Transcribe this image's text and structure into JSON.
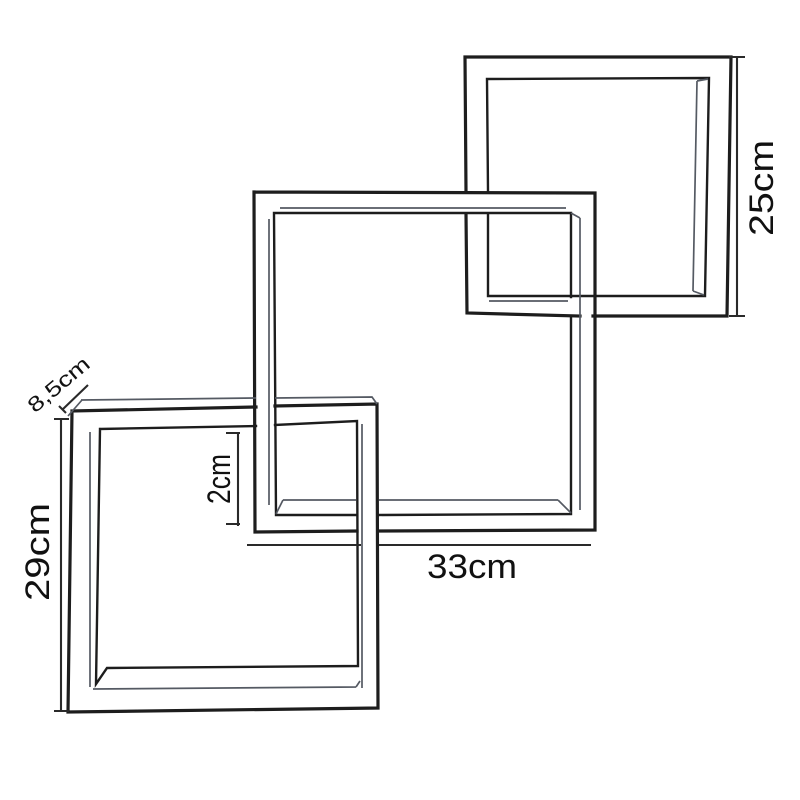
{
  "diagram": {
    "kind": "technical line drawing",
    "subject": "three interlocking square wall shelf cubes"
  },
  "dimensions": {
    "top_right_height": "25cm",
    "bottom_left_height": "29cm",
    "middle_width": "33cm",
    "board_thickness": "2cm",
    "shelf_depth": "8,5cm"
  },
  "colors": {
    "background": "#ffffff",
    "line": "#1d1d1d",
    "depth_line": "#555a63",
    "dimension_line": "#2a2a2a",
    "text": "#111111"
  }
}
